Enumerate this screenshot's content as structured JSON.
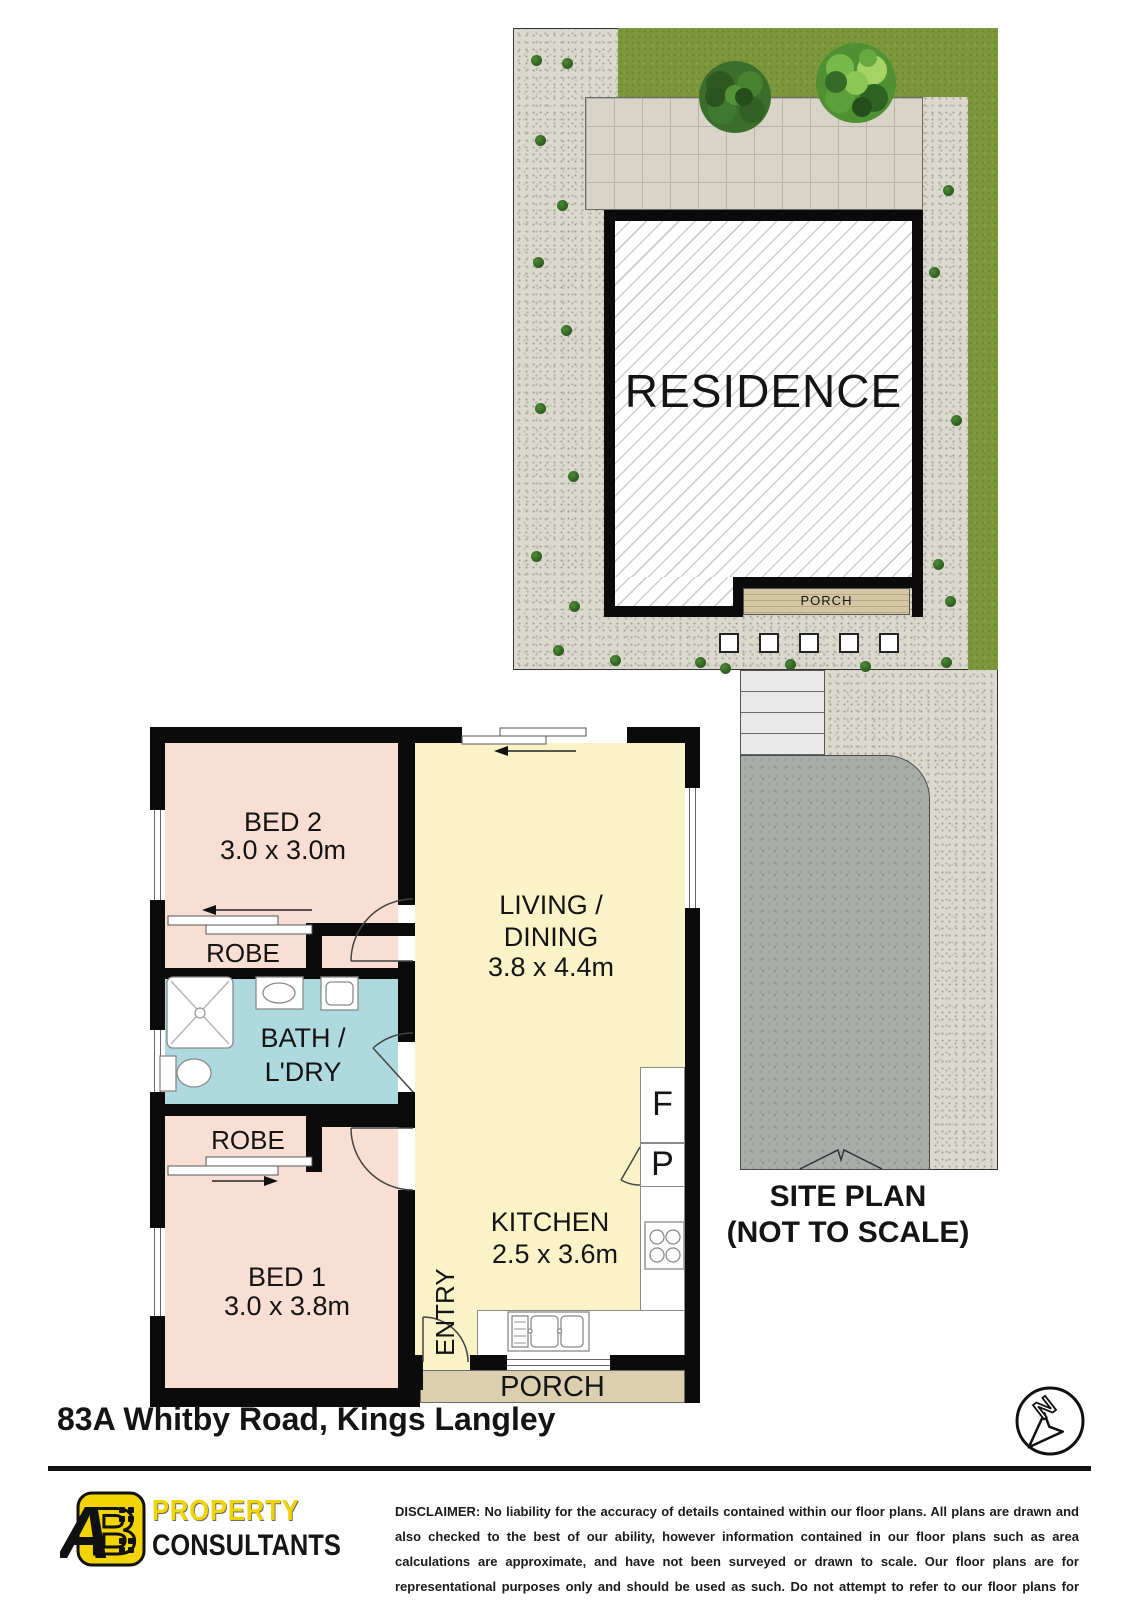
{
  "site_plan": {
    "residence_label": "RESIDENCE",
    "porch_label": "PORCH",
    "caption_line1": "SITE PLAN",
    "caption_line2": "(NOT TO SCALE)",
    "bush_positions": [
      [
        536,
        60
      ],
      [
        567,
        63
      ],
      [
        540,
        140
      ],
      [
        562,
        205
      ],
      [
        538,
        262
      ],
      [
        566,
        330
      ],
      [
        540,
        408
      ],
      [
        573,
        476
      ],
      [
        536,
        556
      ],
      [
        574,
        606
      ],
      [
        558,
        650
      ],
      [
        948,
        190
      ],
      [
        934,
        272
      ],
      [
        956,
        420
      ],
      [
        938,
        564
      ],
      [
        950,
        601
      ],
      [
        946,
        662
      ],
      [
        615,
        660
      ],
      [
        700,
        662
      ],
      [
        725,
        668
      ],
      [
        790,
        664
      ],
      [
        865,
        666
      ]
    ]
  },
  "floor_plan": {
    "bed2": {
      "name": "BED 2",
      "dims": "3.0 x 3.0m"
    },
    "bed1": {
      "name": "BED 1",
      "dims": "3.0 x 3.8m"
    },
    "living": {
      "name_line1": "LIVING /",
      "name_line2": "DINING",
      "dims": "3.8 x 4.4m"
    },
    "kitchen": {
      "name": "KITCHEN",
      "dims": "2.5 x 3.6m"
    },
    "bath": {
      "name_line1": "BATH /",
      "name_line2": "L'DRY"
    },
    "robe_top_label": "ROBE",
    "robe_bottom_label": "ROBE",
    "entry_label": "ENTRY",
    "porch_label": "PORCH",
    "fridge_label": "F",
    "pantry_label": "P"
  },
  "footer": {
    "address": "83A Whitby Road, Kings Langley",
    "logo": {
      "mark_a": "A",
      "mark_b": "B",
      "line1": "PROPERTY",
      "line2": "CONSULTANTS"
    },
    "disclaimer": "DISCLAIMER: No liability for the accuracy of details contained within our floor plans. All plans are drawn and also checked to the best of our ability, however information contained in our floor plans such as area calculations are approximate, and have not been surveyed or drawn to scale. Our floor plans are for representational purposes only and should be used as such. Do not attempt to refer to our floor plans for structural or detailed information.",
    "north_label": "N"
  },
  "colors": {
    "bedroom_fill": "#f9ded4",
    "living_fill": "#fbf3c8",
    "bath_fill": "#aed9de",
    "plan_porch_fill": "#dbcfb0",
    "site_porch_fill": "#d5c7a3",
    "grass": "#7d983b",
    "gravel": "#dbd8ce",
    "driveway": "#a9ada9",
    "wall": "#0b0b0b",
    "logo_yellow": "#f2d500"
  }
}
